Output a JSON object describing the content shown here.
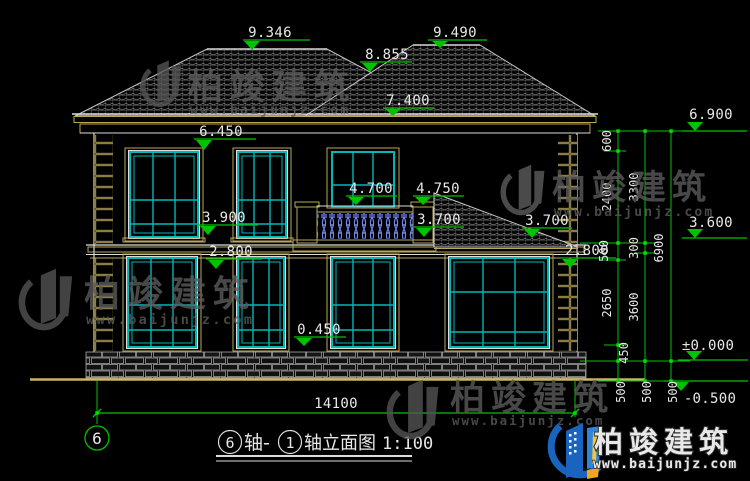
{
  "drawing": {
    "type": "architectural-elevation",
    "scale_note": "1:100",
    "overall_width": "14100",
    "axis_bubble": "6",
    "title": {
      "bubble_start": "6",
      "mid": "轴-",
      "bubble_end": "1",
      "tail": "轴立面图",
      "scale": "1:100"
    },
    "colors": {
      "dimension_green": "#00c300",
      "window_cyan": "#00b7b7",
      "wall_tan": "#b8a858",
      "baluster_blue": "#6f85f5",
      "background": "#000000"
    },
    "elevation_markers": [
      {
        "name": "left-roof-ridge",
        "value": "9.346"
      },
      {
        "name": "right-roof-ridge",
        "value": "9.490"
      },
      {
        "name": "roof-valley",
        "value": "8.855"
      },
      {
        "name": "main-eave-top",
        "value": "7.400"
      },
      {
        "name": "right-eave-level",
        "value": "6.900"
      },
      {
        "name": "upper-window-head",
        "value": "6.450"
      },
      {
        "name": "balcony-rail-top",
        "value": "4.700"
      },
      {
        "name": "porch-roof-high",
        "value": "4.750"
      },
      {
        "name": "upper-window-sill",
        "value": "3.900"
      },
      {
        "name": "porch-roof-left",
        "value": "3.700"
      },
      {
        "name": "porch-roof-right",
        "value": "3.700"
      },
      {
        "name": "second-floor-level",
        "value": "3.600"
      },
      {
        "name": "ground-window-head-left",
        "value": "2.800"
      },
      {
        "name": "ground-window-head-right",
        "value": "2.800"
      },
      {
        "name": "ground-window-sill",
        "value": "0.450"
      },
      {
        "name": "ground-floor-datum",
        "value": "±0.000"
      },
      {
        "name": "site-ground-level",
        "value": "-0.500"
      }
    ],
    "right_dim_chains": {
      "inner": [
        "600",
        "2400",
        "500",
        "2650",
        "450"
      ],
      "middle": [
        "3300",
        "300",
        "3600"
      ],
      "outer": [
        "6900"
      ],
      "below_datum": [
        "500",
        "500",
        "500"
      ]
    }
  },
  "watermark": {
    "cn": "柏竣建筑",
    "url": "www.baijunjz.com"
  },
  "brand": {
    "cn": "柏竣建筑",
    "url": "www.baijunjz.com"
  }
}
